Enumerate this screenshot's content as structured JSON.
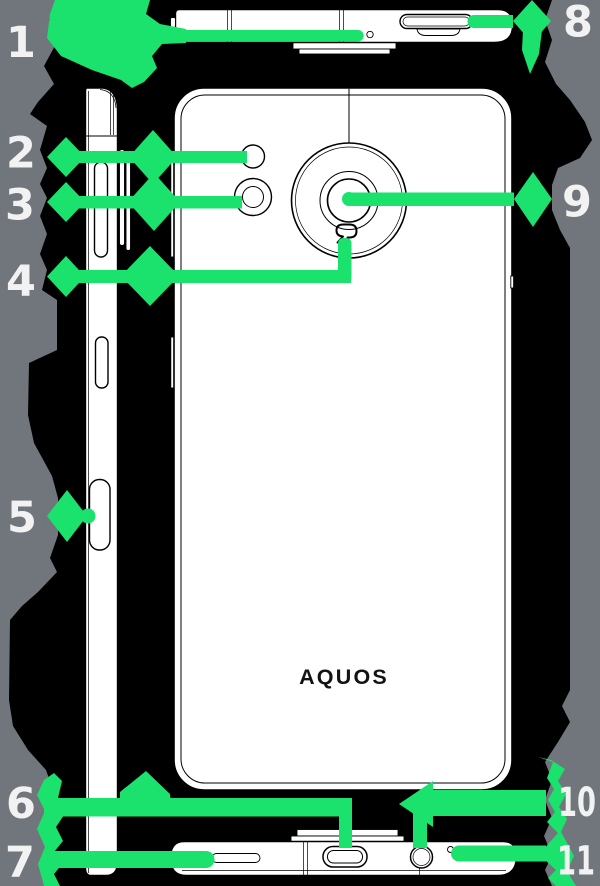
{
  "diagram": {
    "brand": "AQUOS",
    "callouts": [
      {
        "number": "1",
        "target": "top-mic-hole"
      },
      {
        "number": "2",
        "target": "mobile-light"
      },
      {
        "number": "3",
        "target": "sub-camera"
      },
      {
        "number": "4",
        "target": "felica-mark"
      },
      {
        "number": "5",
        "target": "fingerprint-key"
      },
      {
        "number": "6",
        "target": "usb-type-c-port"
      },
      {
        "number": "7",
        "target": "speaker"
      },
      {
        "number": "8",
        "target": "sim-card-tray"
      },
      {
        "number": "9",
        "target": "main-camera"
      },
      {
        "number": "10",
        "target": "earphone-jack"
      },
      {
        "number": "11",
        "target": "bottom-mic-hole"
      }
    ],
    "colors": {
      "highlight_green": "#1be26d",
      "background_gray": "#70767b",
      "blob_black": "#000000",
      "artwork_white": "#ffffff",
      "line_black": "#000000",
      "label_white": "#f2f2f3"
    }
  }
}
